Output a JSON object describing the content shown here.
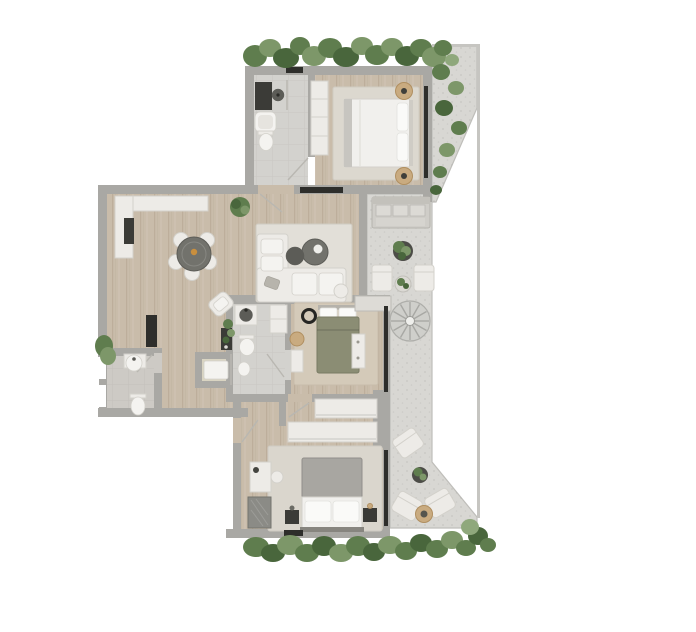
{
  "scene": {
    "kind": "residential-floor-plan",
    "view": "top-down"
  },
  "palette": {
    "background": "#ffffff",
    "wall": "#a9a8a4",
    "wood": "#c9bcaa",
    "tile": "#d3d2ce",
    "tile_powder": "#cdcac5",
    "gravel": "#d8d7d3",
    "gravel_edge": "#bfbeba",
    "cell_floor": "#d9d4c2",
    "rug_light": "#dcd8cf",
    "rug_living": "#e2dfd8",
    "rug_tan": "#d4cab9",
    "rug_tan_edge": "#c7bcab",
    "rug_bottom": "#dad6cd",
    "rug_edge": "#cfcbc2",
    "white_furniture": "#edebe7",
    "white_furniture_edge": "#d3d1cb",
    "white_soft": "#f4f3f0",
    "dark_furniture": "#72726c",
    "dark_furniture_deep": "#5c5c57",
    "black": "#2e2e2b",
    "charcoal": "#3b3b37",
    "glass": "#b9b7b1",
    "green_dark": "#49663c",
    "green_mid": "#5f7d4e",
    "green_light": "#7d9769",
    "green_pale": "#8fa87c",
    "rattan": "#c9ab80",
    "rattan_edge": "#b08f60",
    "brass": "#c98f3e",
    "gray_sofa": "#cfcdc8",
    "gray_sofa_edge": "#b6b4ae",
    "cushion": "#dcdad5",
    "bed_white": "#f1f0ed",
    "bed_gray": "#a8a6a1",
    "bed_gray_edge": "#918f8a",
    "bed_olive": "#8b8d74",
    "bed_olive_edge": "#797b64",
    "pillow": "#fafaf8",
    "pillow_edge": "#e2e2de",
    "stair": "#cfcfcb",
    "stair_edge": "#aeaeaa",
    "stair_step": "#a8a8a4",
    "grille": "#8b8b86",
    "grille_edge": "#74746e",
    "railing": "#c6c5c1"
  },
  "rooms": [
    {
      "id": "bathroom-top",
      "floor": "tile",
      "furniture": [
        "vanity",
        "washbasin",
        "bathtub",
        "toilet",
        "shower-glass"
      ]
    },
    {
      "id": "bedroom-top",
      "floor": "wood",
      "furniture": [
        "wardrobe",
        "area-rug",
        "double-bed",
        "pillows",
        "side-pouf",
        "side-pouf"
      ]
    },
    {
      "id": "living-dining",
      "floor": "wood",
      "furniture": [
        "l-shaped-bench",
        "tv-panel",
        "dining-table",
        "dining-chairs",
        "floor-plant",
        "area-rug",
        "sectional-sofa",
        "coffee-table",
        "coffee-table",
        "pouf",
        "armchair",
        "console",
        "fireplace"
      ]
    },
    {
      "id": "bathroom-middle",
      "floor": "tile",
      "furniture": [
        "vanity",
        "washbasin",
        "shower-column",
        "toilet",
        "bidet"
      ]
    },
    {
      "id": "shower-room",
      "floor": "tile",
      "furniture": [
        "shower-tray"
      ]
    },
    {
      "id": "powder-room",
      "floor": "tile",
      "furniture": [
        "washbasin",
        "toilet"
      ]
    },
    {
      "id": "bedroom-middle",
      "floor": "wood",
      "furniture": [
        "area-rug",
        "double-bed",
        "pillows",
        "round-black-object",
        "stool",
        "bench",
        "dresser"
      ]
    },
    {
      "id": "walk-in-closet",
      "floor": "wood",
      "furniture": [
        "wardrobe",
        "wardrobe"
      ]
    },
    {
      "id": "bedroom-bottom",
      "floor": "wood",
      "furniture": [
        "area-rug",
        "double-bed",
        "pillows",
        "nightstand",
        "nightstand",
        "desk",
        "stool",
        "floor-grille"
      ]
    },
    {
      "id": "terrace",
      "floor": "gravel",
      "furniture": [
        "door-step",
        "outdoor-sofa",
        "potted-plant",
        "outdoor-chair",
        "outdoor-chair",
        "side-table",
        "spiral-staircase",
        "lounge-chair",
        "potted-plant",
        "lounge-chair",
        "lounge-chair",
        "round-table"
      ]
    },
    {
      "id": "planted-border-top",
      "floor": "greenery",
      "furniture": []
    },
    {
      "id": "planted-border-right",
      "floor": "greenery",
      "furniture": []
    },
    {
      "id": "planted-border-bottom",
      "floor": "greenery",
      "furniture": []
    }
  ]
}
